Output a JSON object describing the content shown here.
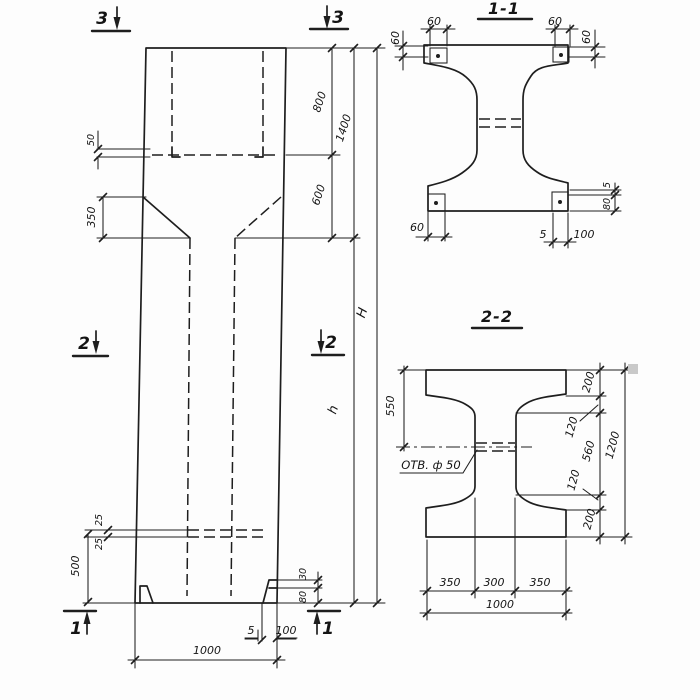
{
  "colors": {
    "background": "#fdfdfd",
    "ink": "#1e1e1e"
  },
  "elevation": {
    "section_marks": {
      "top_left": "3",
      "top_right": "3",
      "mid_left": "2",
      "mid_right": "2",
      "bottom_left": "1",
      "bottom_right": "1"
    },
    "dims": {
      "step": "50",
      "haunch": "350",
      "upper": "800",
      "upper_total": "1400",
      "lower": "600",
      "height_total": "H",
      "height_lower": "h",
      "slot_upper": "25",
      "slot_lower": "25",
      "base": "500",
      "foot_upper": "30",
      "foot_lower": "80",
      "foot_thickness": "5",
      "foot_width": "100",
      "width": "1000"
    }
  },
  "section_1_1": {
    "title": "1-1",
    "dims": {
      "top_left_w": "60",
      "top_left_h": "60",
      "top_right_w": "60",
      "top_right_h": "60",
      "bottom_left_w": "60",
      "bottom_thickness": "5",
      "bottom_width": "100",
      "right_thickness": "5",
      "right_height": "80"
    }
  },
  "section_2_2": {
    "title": "2-2",
    "hole_label": "ОТВ. ф 50",
    "dims": {
      "left": "550",
      "flange_top": "200",
      "taper_top": "120",
      "web": "560",
      "taper_bottom": "120",
      "flange_bottom": "200",
      "height": "1200",
      "bottom_left": "350",
      "bottom_mid": "300",
      "bottom_right": "350",
      "bottom_total": "1000"
    }
  }
}
